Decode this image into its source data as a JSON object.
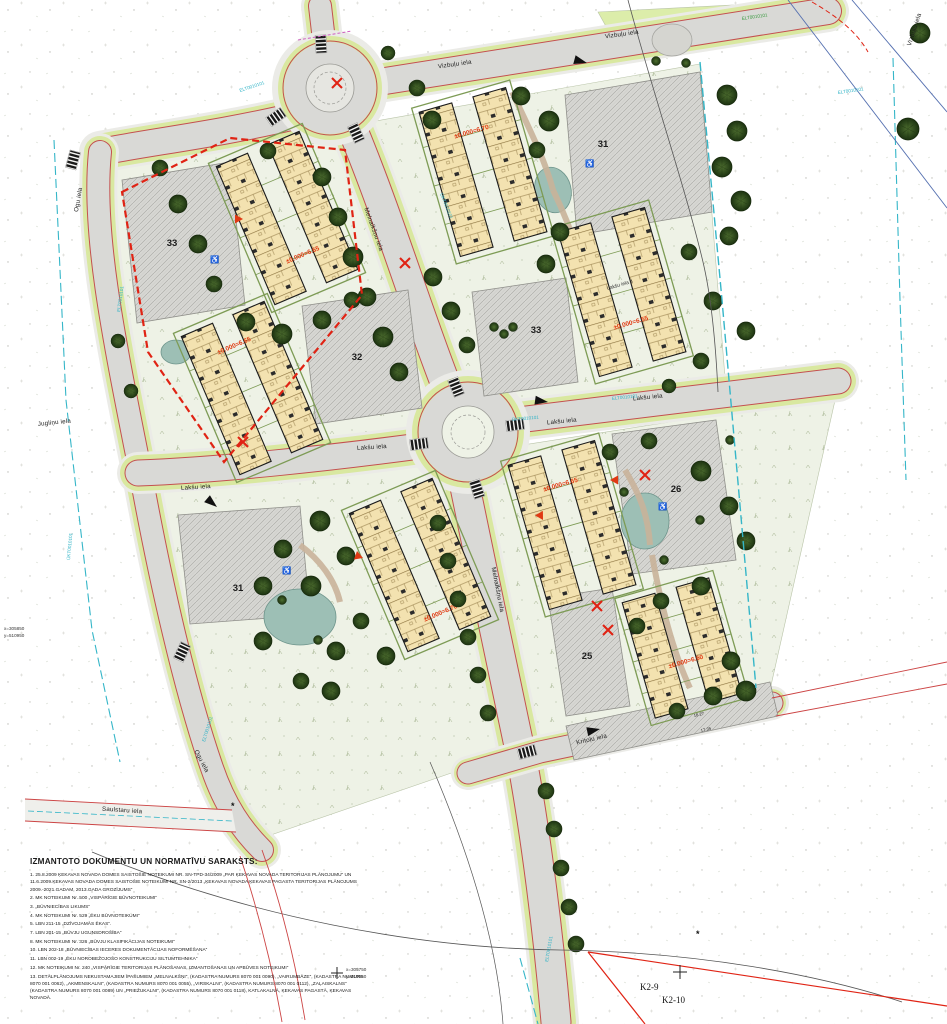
{
  "streets": {
    "vizbulu": "Vizbuļu iela",
    "laksu": "Lakšu iela",
    "melnalksnu": "Melnalkšņu iela",
    "kritolu": "Kritoļu iela",
    "saulstaru": "Saulstaru iela",
    "ogu": "Ogu iela",
    "juglinu": "Jugliņu iela"
  },
  "parking": {
    "top_right": "31",
    "center_west": "32",
    "center_east": "33",
    "west_boundary": "33",
    "east": "26",
    "south": "25",
    "southwest": "31"
  },
  "buildings": {
    "c1_elev": "±0.000=6.65",
    "c2_elev": "±0.000=6.70",
    "c3_elev": "±0.000=6.55",
    "c3_addr": "Lakšu iela 4",
    "c4_elev": "±0.000=6.65",
    "c5_elev": "±0.000=6.70",
    "c6_elev": "±0.000=6.65",
    "c7_elev": "±0.000=6.60"
  },
  "dims": {
    "a": "18.27",
    "b": "17.35"
  },
  "coords": {
    "left_x": "x=305850",
    "left_y": "y=510950",
    "bot_x": "x=305750",
    "bot_y": "y=510950"
  },
  "utilities": {
    "elt": "ELT0010101",
    "ukt": "ŪKT0010101"
  },
  "icons": {
    "wheelchair": "♿",
    "survey_star": "*"
  },
  "sheet_refs": {
    "k2_9": "K2-9",
    "k2_10": "K2-10"
  },
  "legal_docs": {
    "title": "IZMANTOTO DOKUMENTU UN NORMATĪVU SARAKSTS:",
    "items": [
      "1. 25.8.2009 ĶEKAVAS NOVADA DOMES SAISTOŠIE NOTEIKUMI NR. SN-TPD-34/2009 „PAR ĶEKAVAS NOVADA TERITORIJAS PLĀNOJUMU” UN 11.6.2009.ĶEKAVAS NOVADA DOMES SAISTOŠIE NOTEIKUMI NR. SN-2/2013 „ĶEKAVAS NOVADA ĶEKAVAS PAGASTA TERITORIJAS PLĀNOJUMS 2009.-2021.GADAM, 2013.GADA GROZĪJUMS”",
      "2. MK NOTEIKUMI Nr. 500 „VISPĀRĪGIE BŪVNOTEIKUMI”",
      "3. „BŪVNIECĪBAS LIKUMS”",
      "4. MK NOTEIKUMI Nr. 529 „ĒKU BŪVNOTEIKUMI”",
      "5. LBN 211-15 „DZĪVOJAMĀS ĒKAS”.",
      "7. LBN 201-15 „BŪVJU UGUNSDROŠĪBA”",
      "8. MK NOTEIKUMI Nr. 326 „BŪVJU KLASIFIKĀCIJAS NOTEIKUMI”",
      "10. LBN 202-18 „BŪVNIECĪBAS IECERES DOKUMENTĀCIJAS NOFORMĒŠANA”",
      "11. LBN 002-19 „ĒKU NOROBEŽOJOŠO KONSTRUKCIJU SILTUMTEHNIKA”",
      "12. MK NOTEIKUMI Nr. 240 „VISPĀRĪGIE TERITORIJAS PLĀNOŠANAS, IZMANTOŠANAS UN APBŪVES NOTEIKUMI”",
      "13. DETĀLPLĀNOJUMS NEKUSTAMAJIEM ĪPAŠUMIEM „MELNALKŠŅI”, (KADASTRA NUMURS 8070 001 0090), „VAIRUMBĀZE”, (KADASTRA NUMURS 8070 001 0062), „AKMENSKALNI”, (KADASTRA NUMURS 8070 001 0055), „VIRSKALNI”, (KADASTRA NUMURS 8070 001 0112), „ZAĻAISKALNS” (KADASTRA NUMURS 8070 001 0089) UN „PRIEŽUKALNI”, (KADASTRA NUMURS 8070 001 0118), KATLAKALNĀ, ĶEKAVAS PAGASTĀ, ĶEKAVAS NOVADĀ."
    ]
  },
  "colors": {
    "boundary_red": "#e02314",
    "road_gray": "#d9d9d6",
    "verge_green": "#d9e8a0",
    "building_tan": "#f3e2b0",
    "tree_green": "#2b451a",
    "pond_teal": "#9dbfb5",
    "utility_cyan": "#2fb3c6"
  }
}
